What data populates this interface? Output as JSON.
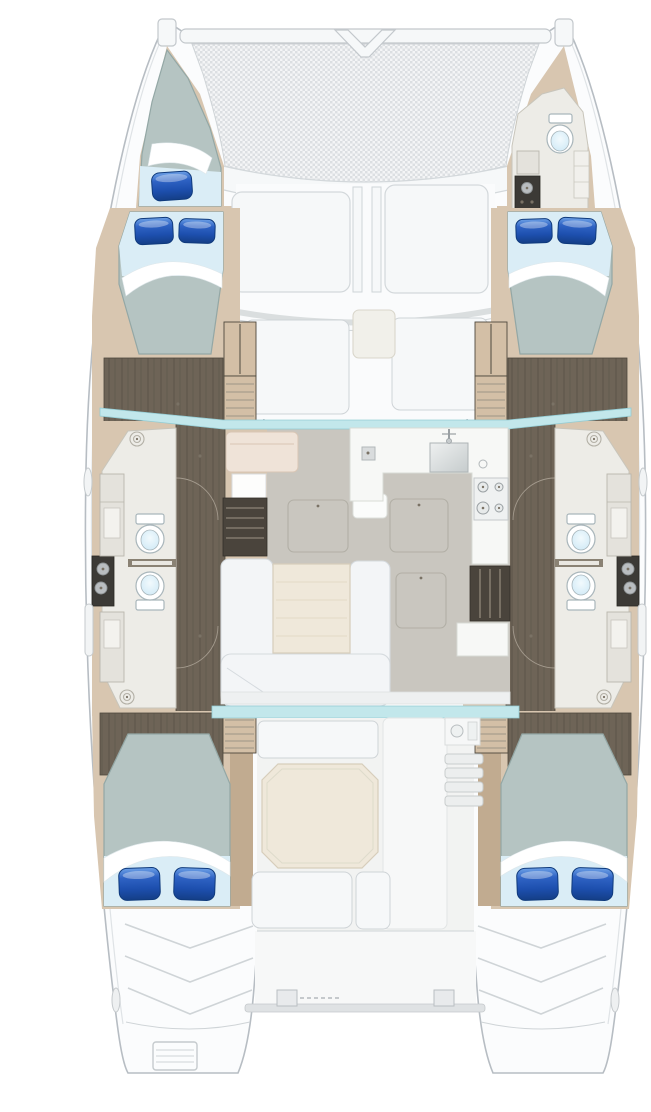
{
  "meta": {
    "title": "Catamaran yacht interior layout — top-down floor plan, 4 double cabins",
    "view": "overhead deck plan",
    "type": "floorplan"
  },
  "colors": {
    "bg": "#ffffff",
    "hull_fill": "#fbfcfd",
    "hull_stroke": "#b7bdc3",
    "hull_inner_line": "#dfe3e6",
    "tramp_fill": "#f4f5f6",
    "tramp_mesh": "#dcdfe2",
    "beam_fill": "#f6f8f9",
    "beam_stroke": "#c3c8cc",
    "deck_fill": "#fafbfc",
    "panel_fill": "#f6f8f9",
    "panel_stroke": "#d3d8db",
    "glass": "#c2e7eb",
    "glass_stroke": "#93ccd4",
    "beige": "#d8c6b0",
    "beige_dark": "#c1ab90",
    "wood": "#6e6457",
    "wood_line": "#5c5449",
    "wood_edge": "#4e483d",
    "head_floor": "#edece7",
    "head_stroke": "#c8c5bb",
    "saloon_floor": "#c9c6bf",
    "hatch_stroke": "#b2afa6",
    "settee_fill": "#f3f5f7",
    "settee_stroke": "#d5dade",
    "table_fill": "#efe8da",
    "table_stroke": "#d7cebb",
    "table_grain": "#e3dac6",
    "counter_fill": "#f7f8f6",
    "counter_stroke": "#d8dbd6",
    "dark_unit": "#3c3a36",
    "dark_unit2": "#4a443c",
    "steel": "#b9bdc0",
    "steel_stroke": "#8f9496",
    "toilet_fill": "#ffffff",
    "toilet_stroke": "#a9b6bb",
    "bowl_light": "#f2fafd",
    "bowl_deep": "#cfe9f6",
    "mattress": "#b5c4c2",
    "mattress_stroke": "#93a7a5",
    "sheet": "#daedf6",
    "pillow_hi": "#6ca0e6",
    "pillow_mid": "#2f63c4",
    "pillow_low": "#1d4fae",
    "pillow_deep": "#143e86",
    "pillow_dark": "#0f3a7c",
    "seat_pink": "#efe3d8",
    "seat_pink_stroke": "#d8c5b4",
    "cockpit_floor": "#f2f3f2",
    "step_line": "#cfd4d7",
    "step_tan": "#d3bfa6",
    "arc": "#a39a8d",
    "drain": "#b3b0a6",
    "handle_dot": "#7a7265",
    "sink_light": "#eef0f0",
    "sink_deep": "#c6cccd"
  },
  "features": {
    "hulls": 2,
    "double_cabins": 4,
    "forepeak_berth": 1,
    "toilets": 5,
    "vanity_units": 3,
    "shower_drains": 4,
    "pillows": 9,
    "saloon": [
      "u-shaped-settee",
      "saloon-table",
      "nav-seat",
      "nav-table",
      "galley-sink",
      "cooktop-4-burner",
      "floor-hatches",
      "hull-stairwells"
    ],
    "cockpit": [
      "octagonal-table",
      "aft-bench",
      "forward-bench",
      "side-steps",
      "wet-bar-module"
    ],
    "bow": [
      "trampoline",
      "forward-crossbeam",
      "seagull-striker"
    ],
    "stern": [
      "swim-platforms",
      "transom-ladder",
      "aft-crossbar",
      "davit-fittings"
    ]
  }
}
